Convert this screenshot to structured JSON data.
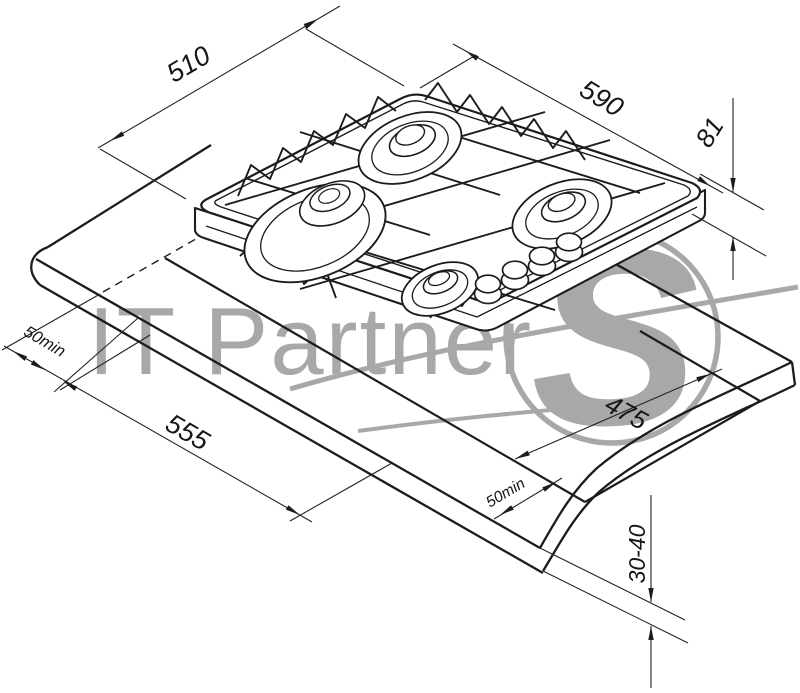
{
  "meta": {
    "type": "installation-diagram",
    "subject": "built-in 4-burner gas hob worktop cutout drawing"
  },
  "dimensions": {
    "hob_depth": {
      "label": "510"
    },
    "hob_width": {
      "label": "590"
    },
    "hob_height": {
      "label": "81"
    },
    "side_clearance": {
      "label": "50min"
    },
    "cutout_length": {
      "label": "555"
    },
    "cutout_depth": {
      "label": "475"
    },
    "front_clearance": {
      "label": "50min"
    },
    "worktop_thickness": {
      "label": "30-40"
    }
  },
  "watermark": {
    "text": "IT Partner",
    "logo_letter": "S"
  },
  "colors": {
    "line": "#1c1c1c",
    "dimension": "#242424",
    "watermark": "#969696",
    "background": "#ffffff"
  }
}
